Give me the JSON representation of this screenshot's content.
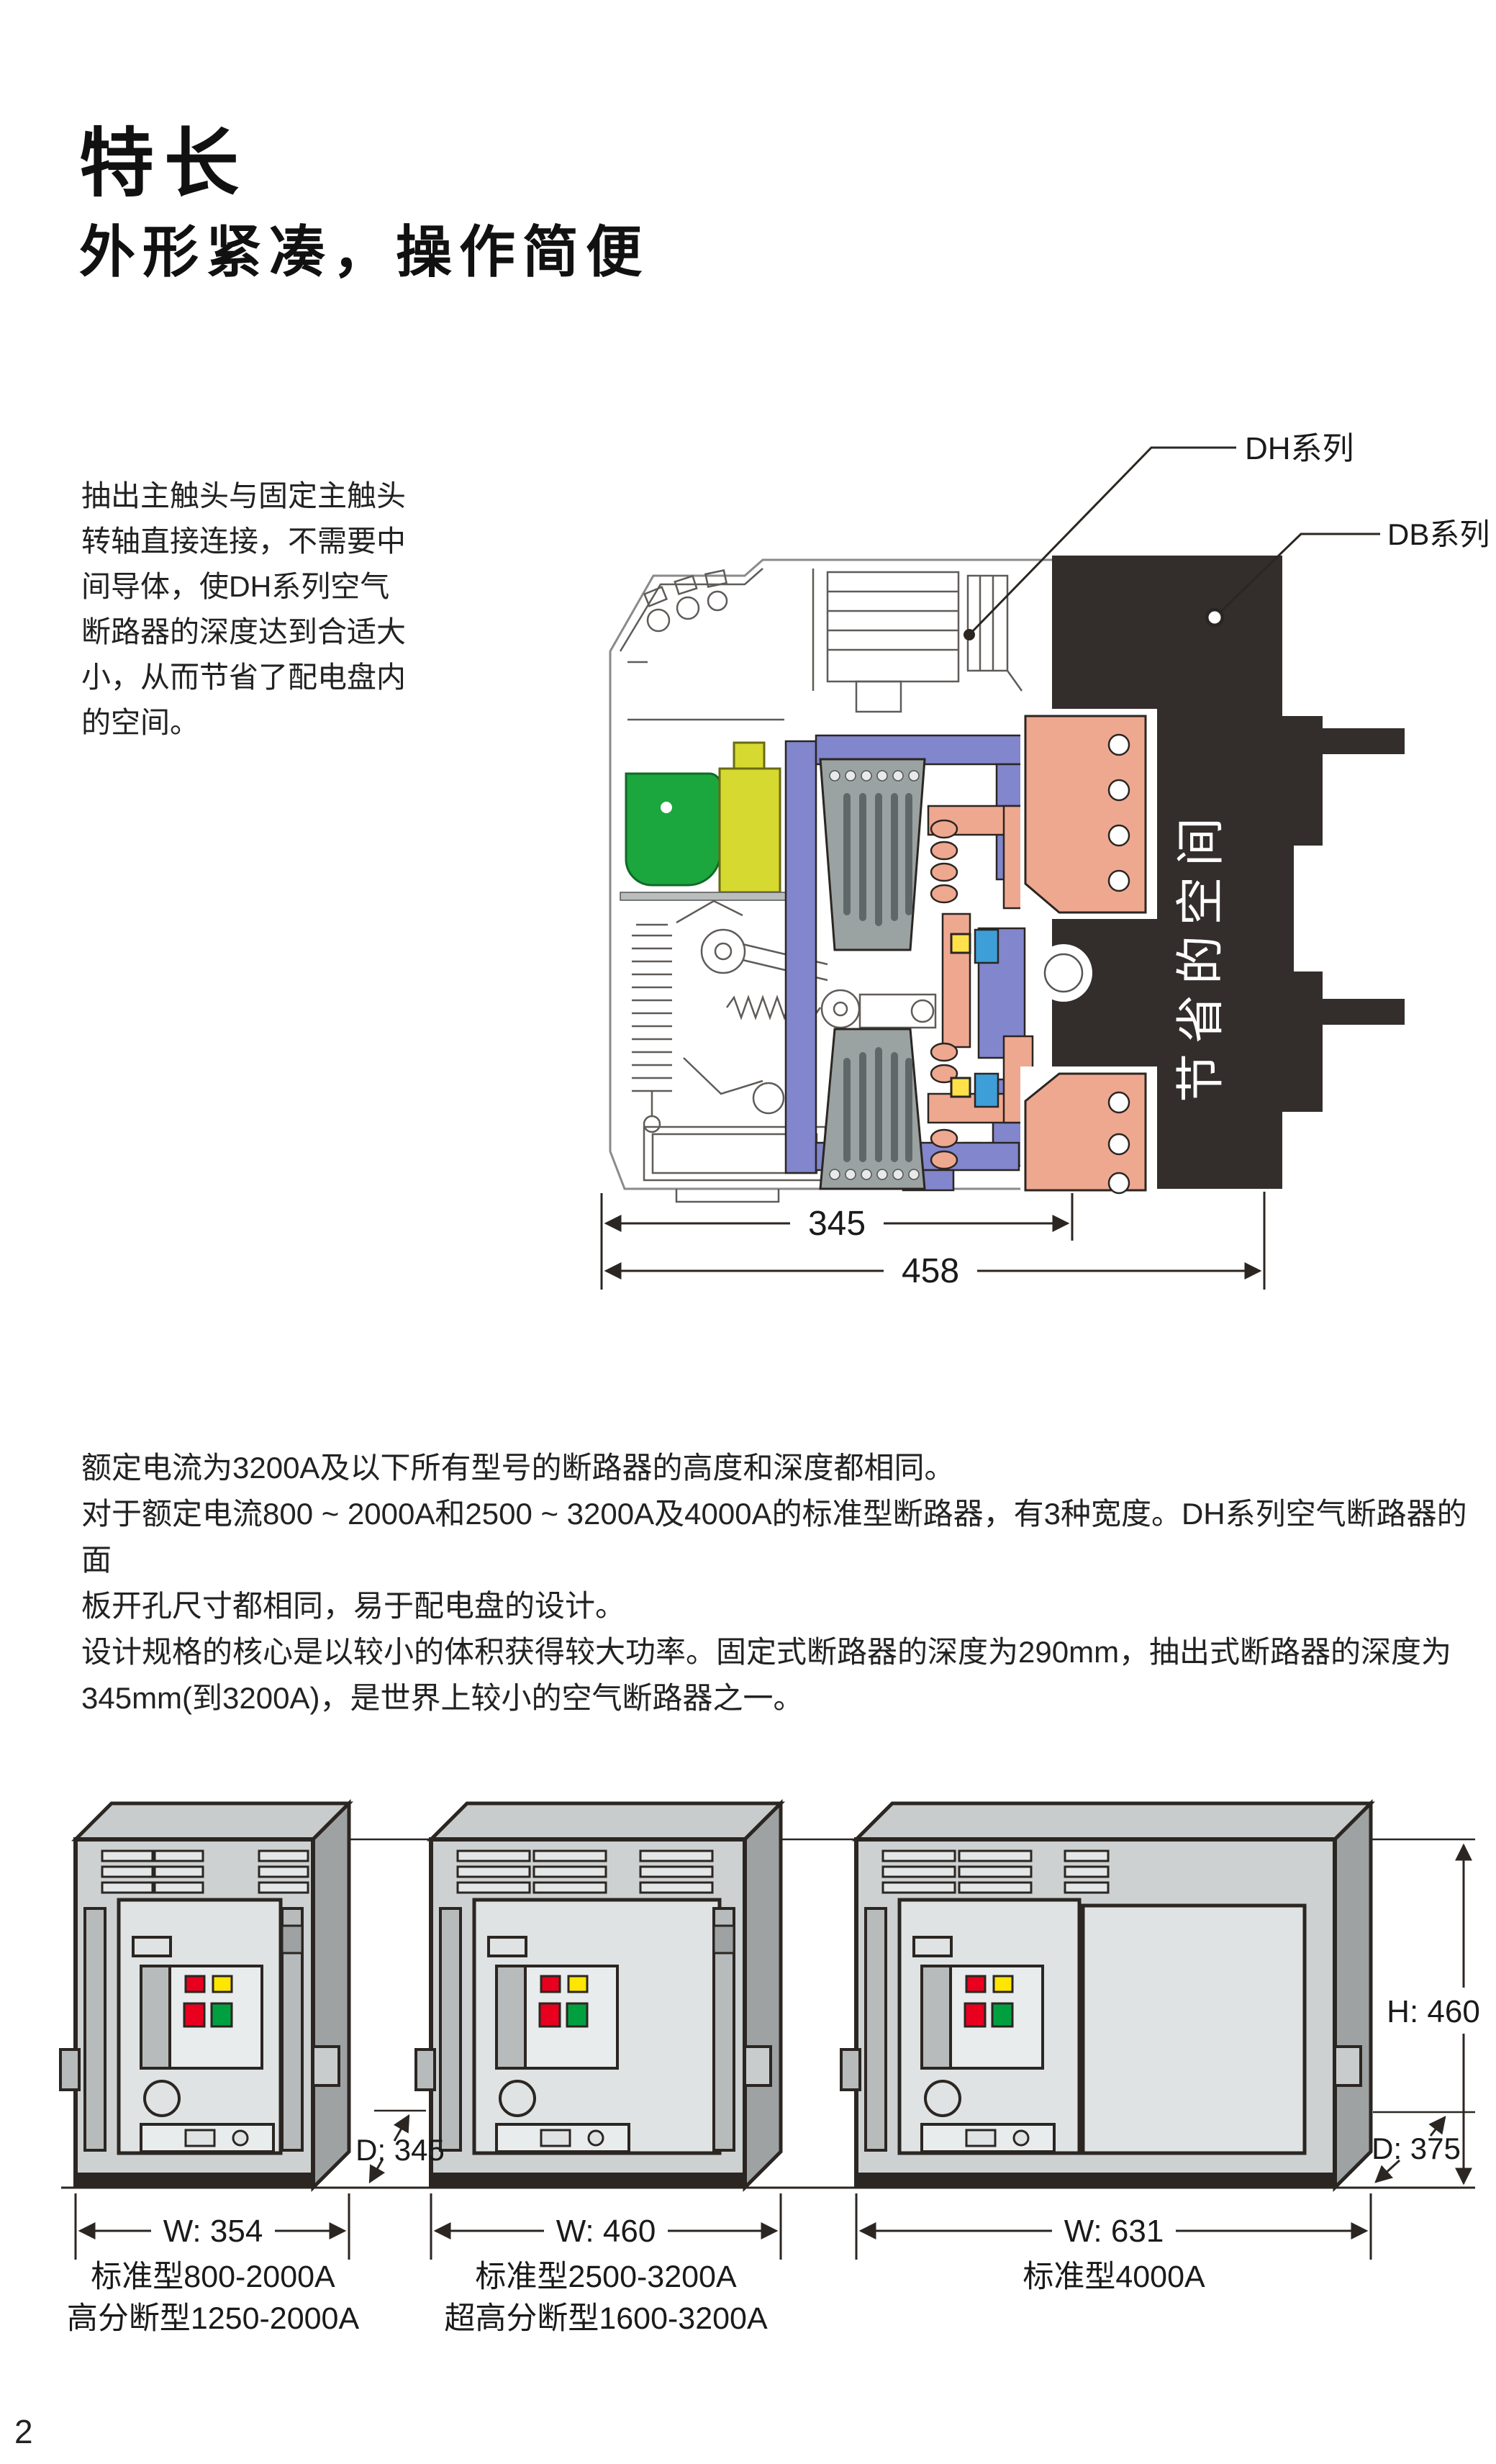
{
  "page": {
    "title": "特长",
    "subtitle": "外形紧凑，操作简便",
    "page_number": "2",
    "intro_lines": [
      "抽出主触头与固定主触头",
      "转轴直接连接，不需要中",
      "间导体，使DH系列空气",
      "断路器的深度达到合适大",
      "小，从而节省了配电盘内",
      "的空间。"
    ],
    "body_lines": [
      "额定电流为3200A及以下所有型号的断路器的高度和深度都相同。",
      "对于额定电流800 ~ 2000A和2500 ~ 3200A及4000A的标准型断路器，有3种宽度。DH系列空气断路器的面",
      "板开孔尺寸都相同，易于配电盘的设计。",
      "设计规格的核心是以较小的体积获得较大功率。固定式断路器的深度为290mm，抽出式断路器的深度为",
      "345mm(到3200A)，是世界上较小的空气断路器之一。"
    ]
  },
  "diagram": {
    "label_dh": "DH系列",
    "label_db": "DB系列",
    "saved_space_text": "节省的空间",
    "dim_345": "345",
    "dim_458": "458"
  },
  "models": {
    "w_labels": [
      "W: 354",
      "W: 460",
      "W: 631"
    ],
    "d_label_12": "D: 345",
    "d_label_3": "D: 375",
    "h_label": "H: 460",
    "captions_col1": [
      "标准型800-2000A",
      "高分断型1250-2000A"
    ],
    "captions_col2": [
      "标准型2500-3200A",
      "超高分断型1600-3200A"
    ],
    "captions_col3": [
      "标准型4000A"
    ]
  },
  "colors": {
    "dark_region": "#332e2c",
    "green_part": "#1ca63e",
    "yellow_part": "#d6d92f",
    "purple_part": "#8286cc",
    "copper_part": "#efa890",
    "arc_chute": "#9ba2a2",
    "lamp_red": "#e8001e",
    "lamp_yellow": "#ffe600",
    "lamp_green": "#00a040",
    "outline": "#2b2622"
  }
}
